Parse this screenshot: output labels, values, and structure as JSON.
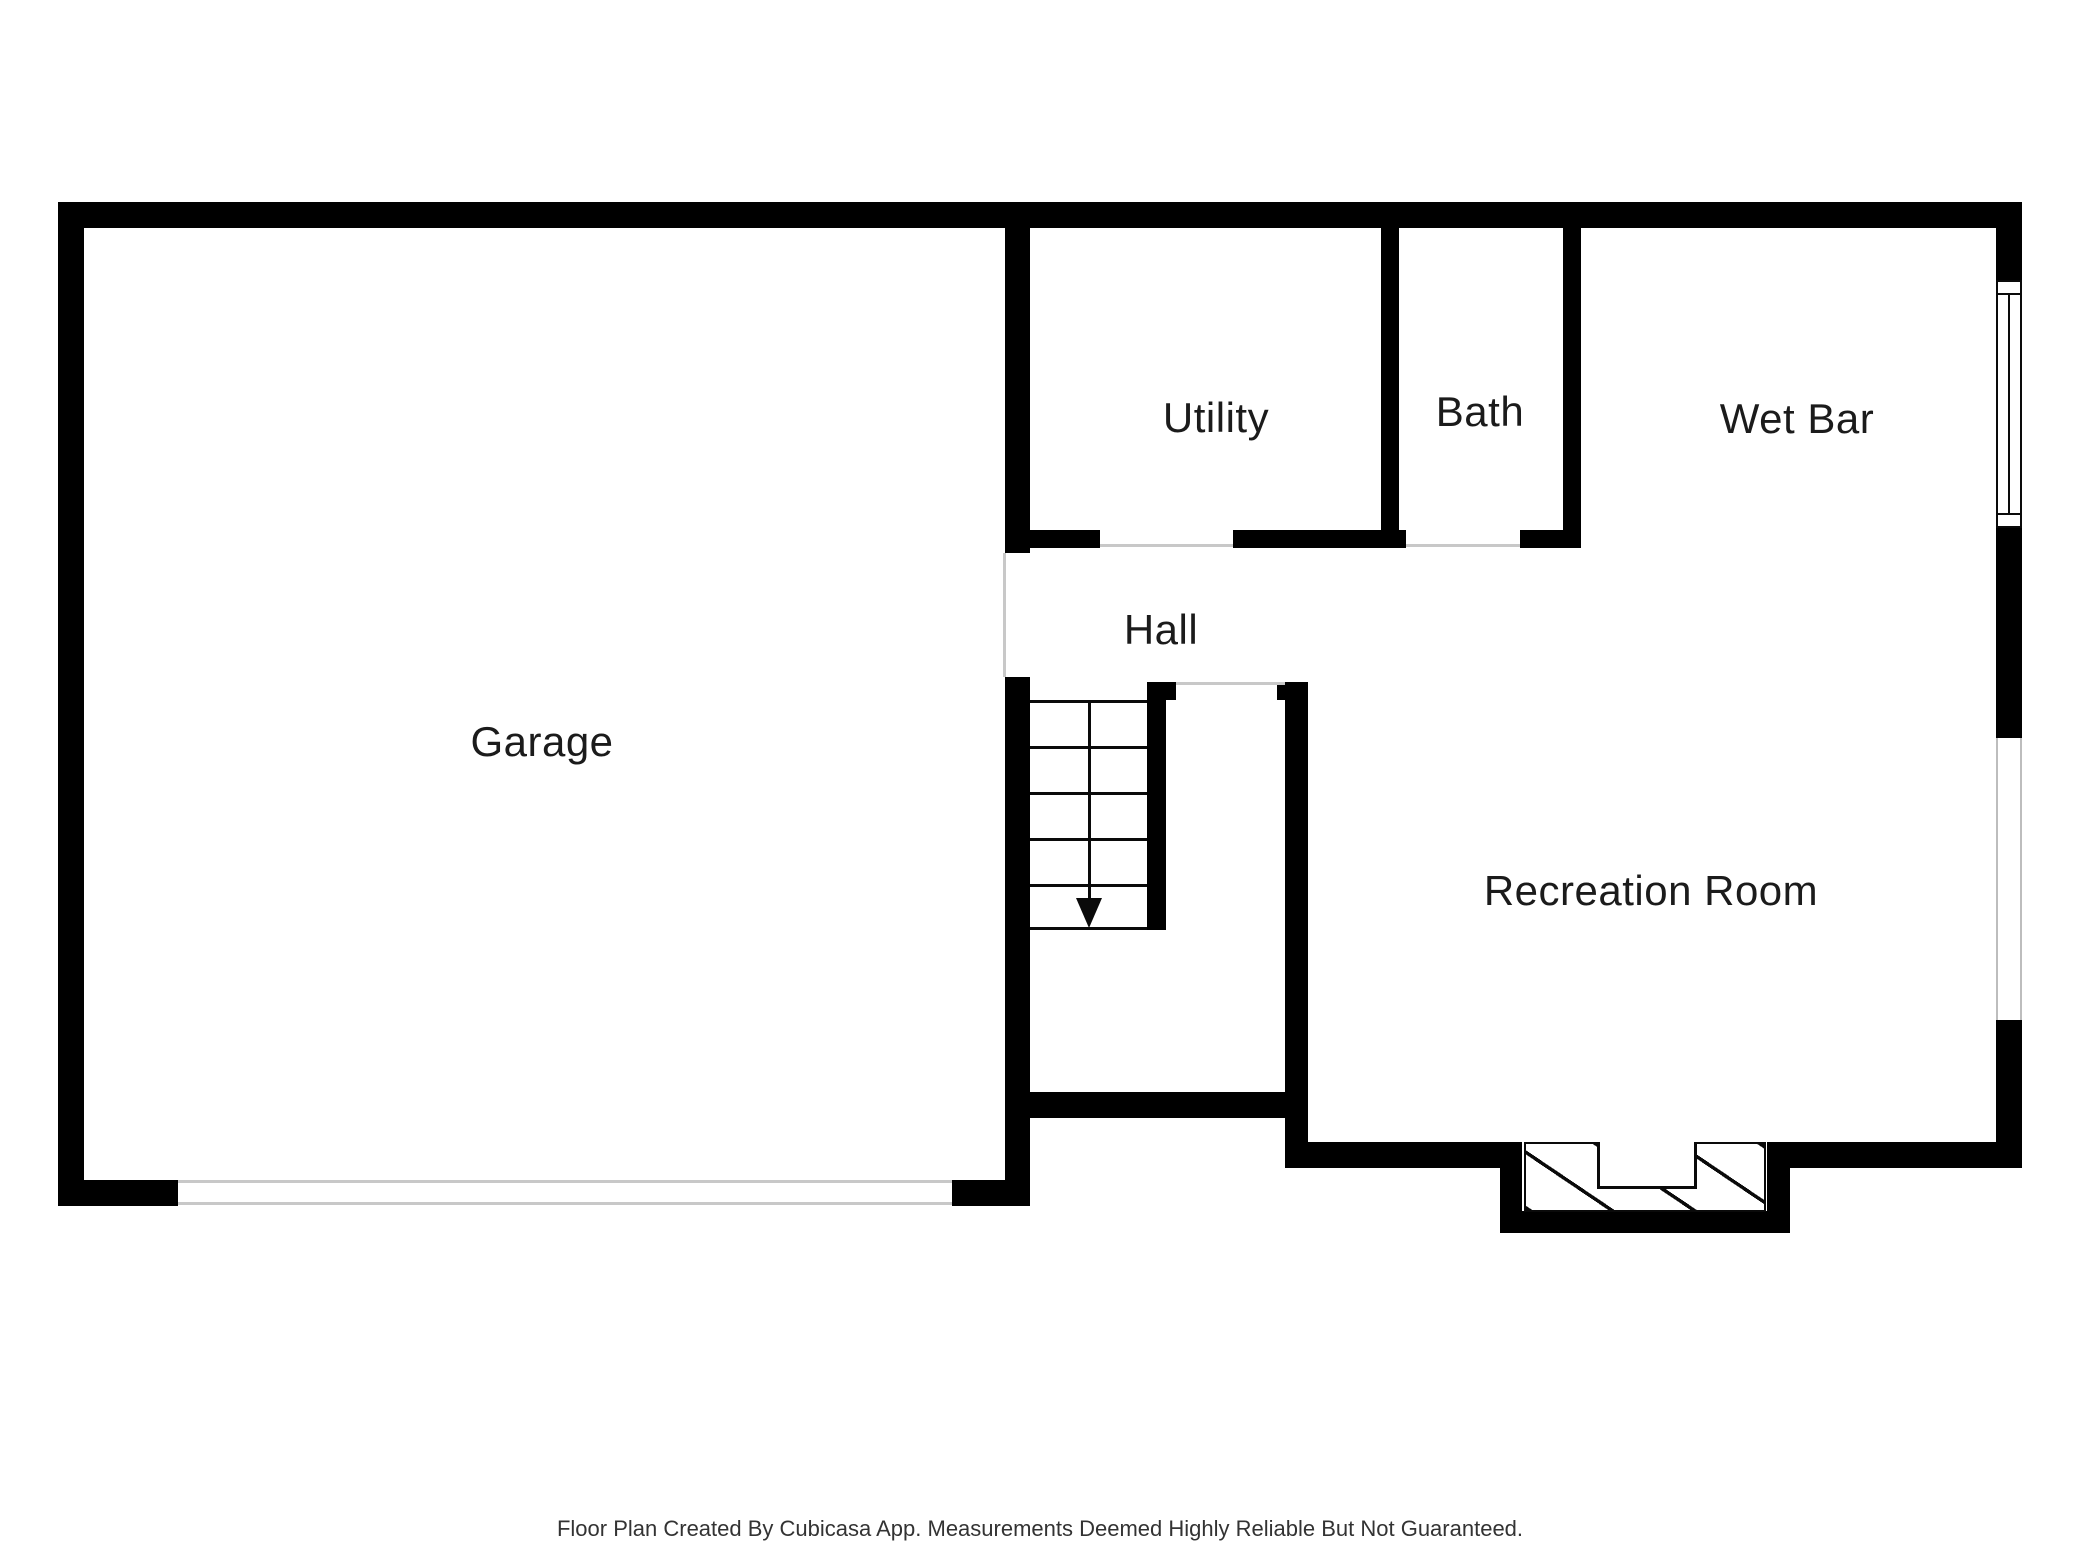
{
  "title": "Basement floor plan",
  "rooms": {
    "garage": {
      "label": "Garage"
    },
    "utility": {
      "label": "Utility"
    },
    "bath": {
      "label": "Bath"
    },
    "wet_bar": {
      "label": "Wet Bar"
    },
    "hall": {
      "label": "Hall"
    },
    "recreation_room": {
      "label": "Recreation Room"
    }
  },
  "features": {
    "stairs_arrow_icon": "stairs-down-arrow",
    "garage_door": "double-line opening",
    "windows": 2,
    "fireplace": "hatched hearth with firebox"
  },
  "footer": {
    "disclaimer": "Floor Plan Created By Cubicasa App. Measurements Deemed Highly Reliable But Not Guaranteed."
  },
  "colors": {
    "wall": "#000000",
    "background": "#ffffff",
    "opening_line": "#c8c8c8",
    "text": "#1b1b1b",
    "footer_text": "#333333"
  }
}
